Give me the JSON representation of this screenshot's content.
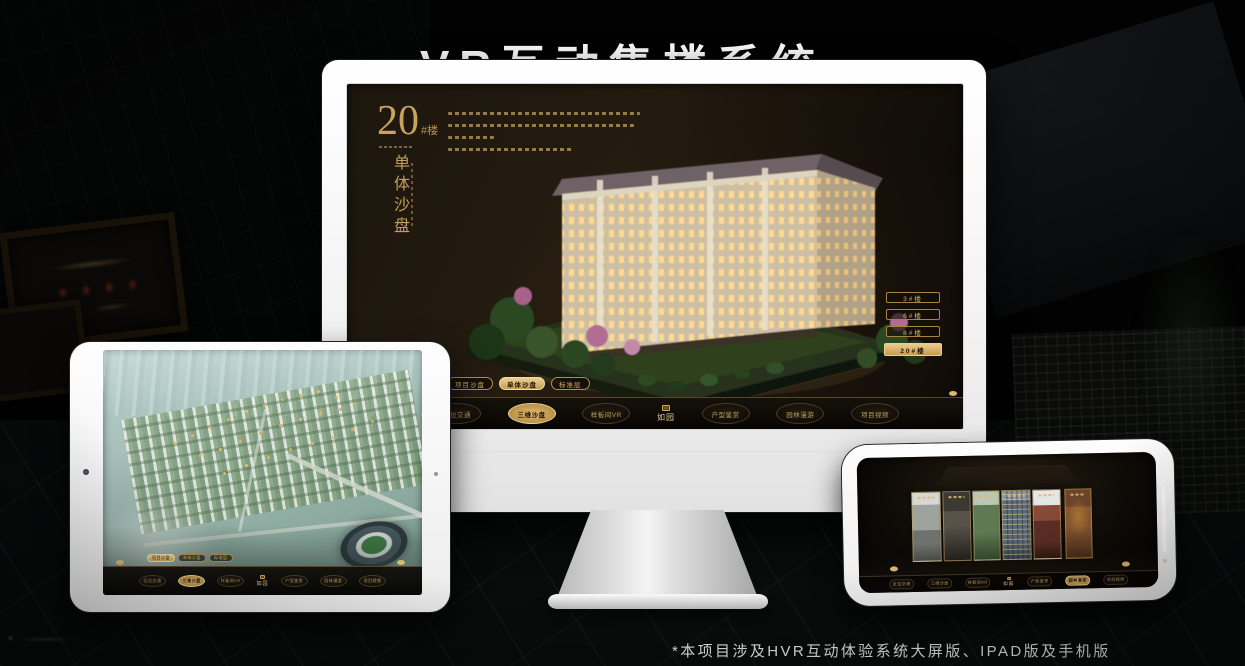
{
  "page": {
    "title": "VR互动售楼系统",
    "footnote": "*本项目涉及HVR互动体验系统大屏版、IPAD版及手机版"
  },
  "colors": {
    "gold_accent": "#d2a95f",
    "gold_bright": "#ecd194",
    "screen_brown": "#1b150d",
    "device_white": "#f5f5f5"
  },
  "monitor": {
    "building_no": "20",
    "building_no_suffix": "#楼",
    "section_title": "单体沙盘",
    "building_buttons": [
      {
        "label": "3#楼",
        "active": false
      },
      {
        "label": "6#楼",
        "active": false
      },
      {
        "label": "8#楼",
        "active": false
      },
      {
        "label": "20#楼",
        "active": true
      }
    ],
    "tabs": [
      {
        "label": "项目沙盘",
        "active": false
      },
      {
        "label": "单体沙盘",
        "active": true
      },
      {
        "label": "标准层",
        "active": false
      }
    ],
    "nav": {
      "logo": "如园",
      "items": [
        {
          "label": "区位交通",
          "active": false
        },
        {
          "label": "三维沙盘",
          "active": true
        },
        {
          "label": "样板间VR",
          "active": false
        },
        {
          "label": "户型鉴赏",
          "active": false
        },
        {
          "label": "园林漫游",
          "active": false
        },
        {
          "label": "项目视频",
          "active": false
        }
      ]
    }
  },
  "tablet": {
    "tabs": [
      {
        "label": "项目沙盘",
        "active": true
      },
      {
        "label": "单体沙盘",
        "active": false
      },
      {
        "label": "标准层",
        "active": false
      }
    ],
    "nav": {
      "logo": "如园",
      "items": [
        {
          "label": "区位交通",
          "active": false
        },
        {
          "label": "三维沙盘",
          "active": true
        },
        {
          "label": "样板间VR",
          "active": false
        },
        {
          "label": "户型鉴赏",
          "active": false
        },
        {
          "label": "园林漫游",
          "active": false
        },
        {
          "label": "项目视频",
          "active": false
        }
      ]
    }
  },
  "phone": {
    "gallery_panel_count": 6,
    "nav": {
      "logo": "如园",
      "items": [
        {
          "label": "区位交通",
          "active": false
        },
        {
          "label": "三维沙盘",
          "active": false
        },
        {
          "label": "样板间VR",
          "active": false
        },
        {
          "label": "户型鉴赏",
          "active": false
        },
        {
          "label": "园林漫游",
          "active": true
        },
        {
          "label": "项目视频",
          "active": false
        }
      ]
    }
  }
}
